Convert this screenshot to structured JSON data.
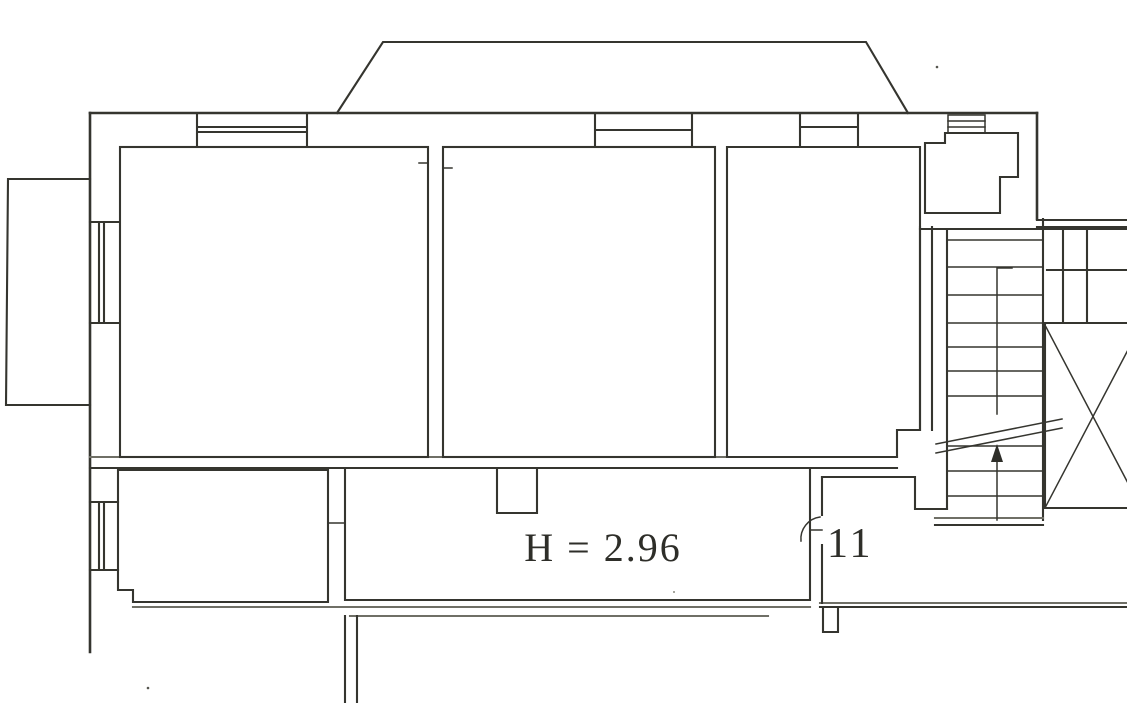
{
  "document": {
    "kind": "scanned architectural floor plan",
    "page_background": "#ffffff",
    "ink_color": "#35352f"
  },
  "labels": {
    "ceiling_height": "H = 2.96",
    "unit_number": "11"
  },
  "features": {
    "balcony_top": "trapezoid balcony on top wall",
    "balcony_left": "rectangular balcony on left wall",
    "rooms": [
      "room-top-left",
      "room-top-middle",
      "room-top-right",
      "room-bottom-left",
      "room-bottom-middle",
      "closet-top-right"
    ],
    "hallway": "landing numbered 11",
    "staircase": "stair flight with up-direction arrow and section break lines",
    "elevator_shaft": "shaft crossed with X",
    "windows": 6
  }
}
